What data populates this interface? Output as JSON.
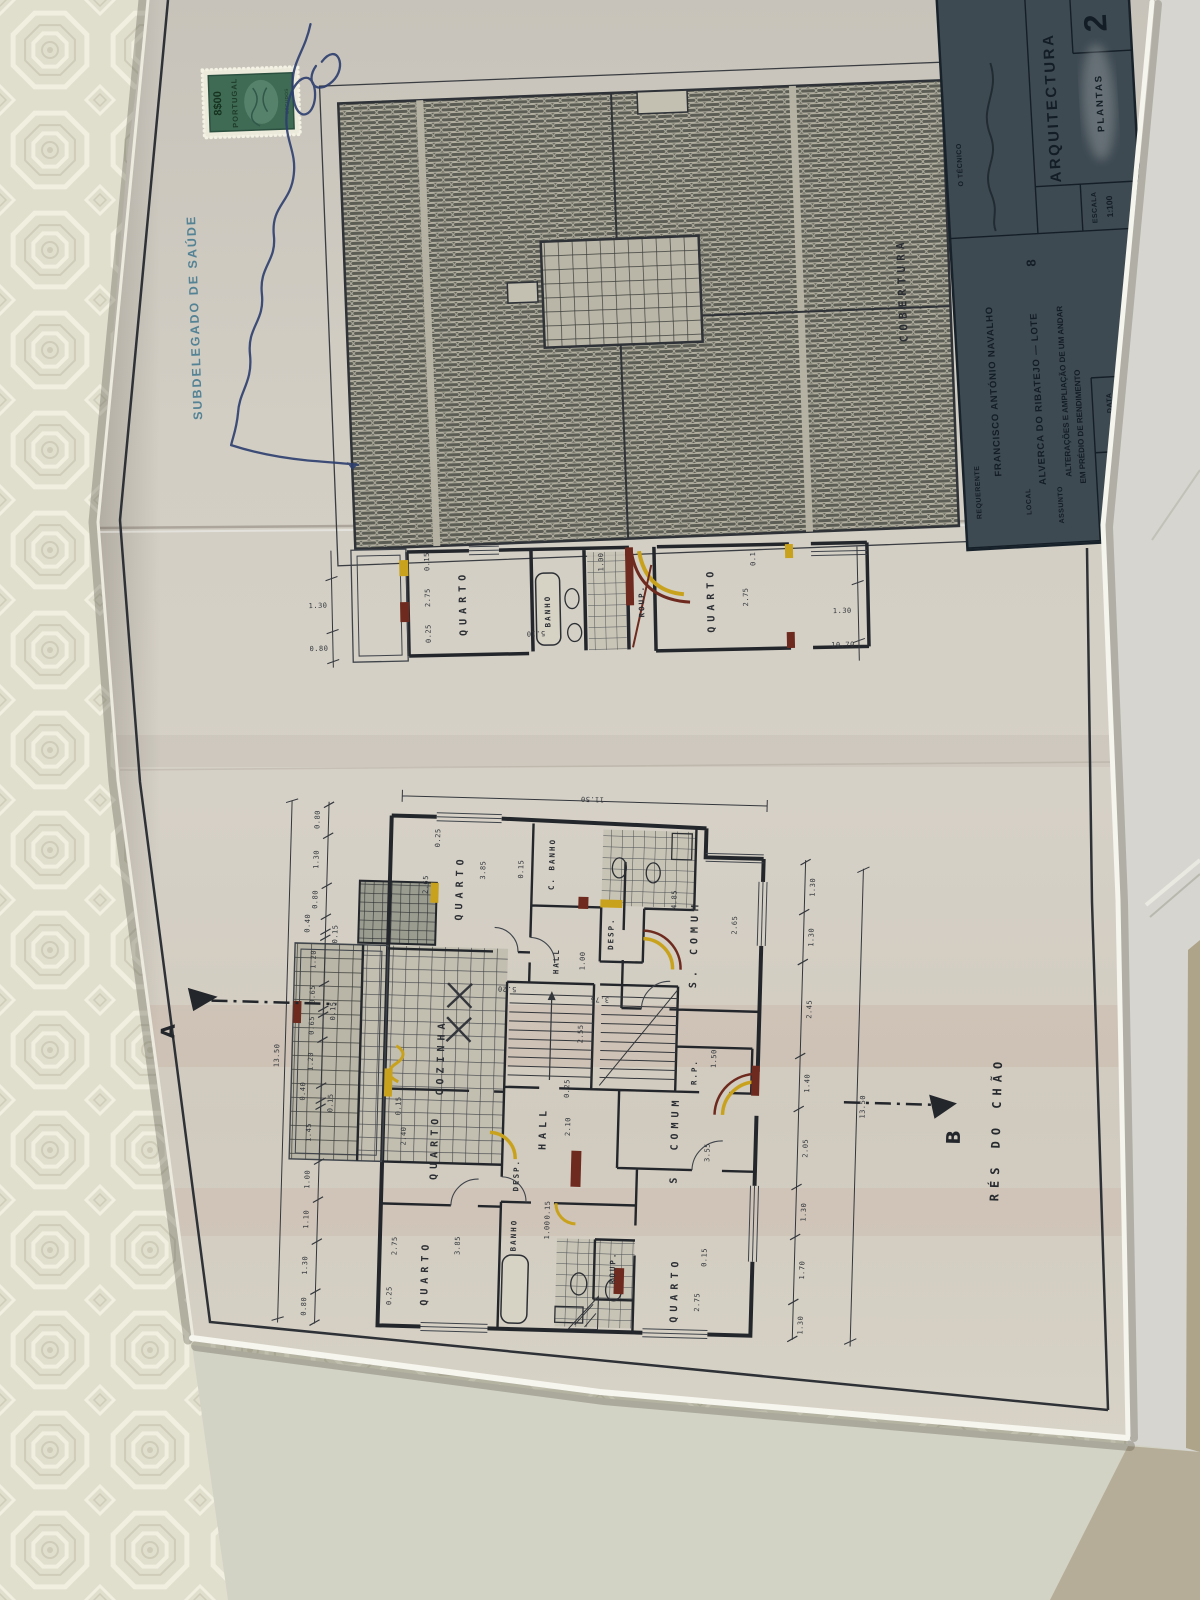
{
  "colors": {
    "alteration_yellow": "#c9a21d",
    "alteration_red": "#6e2a1e",
    "stamp_green": "#3f6b55",
    "signature_ink": "#2c3e6e",
    "paper": "#d0ccc2",
    "title_block_bg": "#3e4a52"
  },
  "stamps": {
    "subdelegado": "SUBDELEGADO DE SAÚDE",
    "tax_value": "8$00",
    "tax_country": "PORTUGAL",
    "tax_currency": "ESCUDOS"
  },
  "roof": {
    "label": "COBERTURA"
  },
  "upper": {
    "rooms": {
      "quarto_l": "QUARTO",
      "banho": "BANHO",
      "roup": "ROUP.",
      "quarto_r": "QUARTO"
    },
    "dims_left": [
      "0.80",
      "1.30"
    ],
    "dims_right": [
      "10.70",
      "1.30"
    ],
    "dims_inner": [
      "0.25",
      "2.75",
      "0.15",
      "5.10",
      "1.00",
      "2.75",
      "0.1"
    ]
  },
  "main": {
    "label": "RÉS DO CHÃO",
    "marker_a": "A",
    "marker_b": "B",
    "total_w": "11.50",
    "total_h_left": "13.50",
    "total_h_right": "13.50",
    "rooms": {
      "quarto1": "QUARTO",
      "cbanho": "C. BANHO",
      "desp1": "DESP.",
      "hall1": "HALL",
      "scomum1": "S. COMUM",
      "cozinha": "COZINHA",
      "hall2": "HALL",
      "rp": "R.P.",
      "scomum2": "S. COMUM",
      "desp2": "DESP.",
      "banho": "BANHO",
      "roup": "ROUP.",
      "quarto2": "QUARTO",
      "quarto3": "QUARTO",
      "quarto4": "QUARTO"
    },
    "dims_left": [
      "0.80",
      "1.30",
      "0.80",
      "0.40",
      "0.15",
      "1.20",
      "0.65",
      "0.15",
      "0.65",
      "1.20",
      "0.40",
      "0.15",
      "1.45",
      "1.00",
      "1.10",
      "1.30",
      "0.80"
    ],
    "dims_right": [
      "1.30",
      "1.30",
      "2.45",
      "1.40",
      "2.05",
      "1.30",
      "1.70",
      "1.30"
    ],
    "dims_inner": [
      "2.65",
      "3.85",
      "0.25",
      "0.15",
      "4.85",
      "2.65",
      "5.20",
      "3.75",
      "2.55",
      "0.25",
      "2.10",
      "1.00",
      "3.55",
      "1.50",
      "2.40",
      "0.15",
      "2.75",
      "0.25",
      "3.85",
      "1.00",
      "0.15",
      "2.75",
      "0.15"
    ]
  },
  "title_block": {
    "sheet_number": "2",
    "tecnico_label": "O TÉCNICO",
    "discipline": "ARQUITECTURA",
    "doc_type": "PLANTAS",
    "escala_label": "ESCALA",
    "escala_value": "1:100",
    "requerente_label": "REQUERENTE",
    "requerente_value": "FRANCISCO ANTÓNIO NAVALHO",
    "local_label": "LOCAL",
    "local_value": "ALVERCA DO RIBATEJO — LOTE",
    "lote_number": "8",
    "assunto_label": "ASSUNTO",
    "assunto_line1": "ALTERAÇÕES E AMPLIAÇÃO DE UM ANDAR",
    "assunto_line2": "EM PRÉDIO DE RENDIMENTO",
    "processo_label": "PROCESSO Nº",
    "data_label": "DATA"
  }
}
